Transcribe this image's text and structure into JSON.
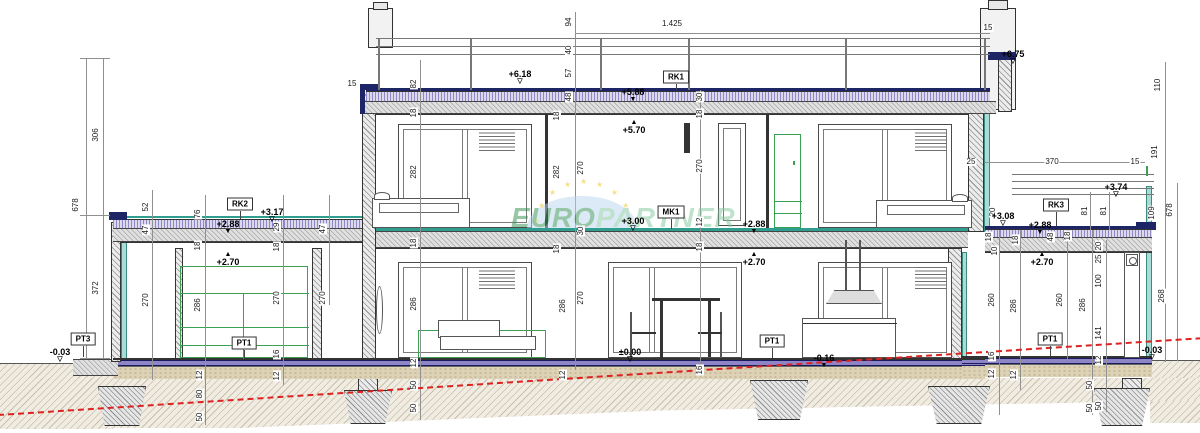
{
  "watermark": {
    "text_primary": "EURO",
    "text_secondary": "PARTNER"
  },
  "reference_boxes": [
    {
      "t": "RK1",
      "x": 676,
      "y": 77,
      "ly": 90
    },
    {
      "t": "RK2",
      "x": 240,
      "y": 204,
      "ly": 219
    },
    {
      "t": "RK3",
      "x": 1056,
      "y": 205,
      "ly": 226
    },
    {
      "t": "MK1",
      "x": 671,
      "y": 212,
      "ly": 229
    },
    {
      "t": "PT1",
      "x": 244,
      "y": 343,
      "ly": 358
    },
    {
      "t": "PT1",
      "x": 772,
      "y": 341,
      "ly": 358
    },
    {
      "t": "PT1",
      "x": 1050,
      "y": 339,
      "ly": 356
    },
    {
      "t": "PT3",
      "x": 83,
      "y": 339,
      "ly": 357
    }
  ],
  "level_marks": [
    {
      "t": "+6.18",
      "x": 520,
      "y": 70,
      "m": "od"
    },
    {
      "t": "+5.88",
      "x": 633,
      "y": 88,
      "m": "fd"
    },
    {
      "t": "+5.70",
      "x": 634,
      "y": 120,
      "m": "fu"
    },
    {
      "t": "+6.75",
      "x": 1013,
      "y": 50,
      "m": "od"
    },
    {
      "t": "+3.74",
      "x": 1116,
      "y": 183,
      "m": "od"
    },
    {
      "t": "+3.17",
      "x": 272,
      "y": 208,
      "m": "od"
    },
    {
      "t": "+2.88",
      "x": 228,
      "y": 220,
      "m": "fd"
    },
    {
      "t": "+2.70",
      "x": 228,
      "y": 252,
      "m": "fu"
    },
    {
      "t": "+3.00",
      "x": 633,
      "y": 217,
      "m": "od"
    },
    {
      "t": "+2.88",
      "x": 754,
      "y": 220,
      "m": "fd"
    },
    {
      "t": "+2.70",
      "x": 754,
      "y": 252,
      "m": "fu"
    },
    {
      "t": "+3.08",
      "x": 1003,
      "y": 212,
      "m": "od"
    },
    {
      "t": "+2.88",
      "x": 1040,
      "y": 221,
      "m": "fd"
    },
    {
      "t": "+2.70",
      "x": 1042,
      "y": 252,
      "m": "fu"
    },
    {
      "t": "±0.00",
      "x": 630,
      "y": 348,
      "m": "od"
    },
    {
      "t": "-0.16",
      "x": 824,
      "y": 354,
      "m": "fd"
    },
    {
      "t": "-0.03",
      "x": 60,
      "y": 348,
      "m": "od"
    },
    {
      "t": "-0.03",
      "x": 1152,
      "y": 346,
      "m": "od"
    }
  ],
  "dimensions": [
    {
      "t": "678",
      "x": 76,
      "y": 205,
      "r": 1
    },
    {
      "t": "306",
      "x": 96,
      "y": 135,
      "r": 1
    },
    {
      "t": "372",
      "x": 96,
      "y": 288,
      "r": 1
    },
    {
      "t": "52",
      "x": 146,
      "y": 207,
      "r": 1
    },
    {
      "t": "47",
      "x": 146,
      "y": 230,
      "r": 1
    },
    {
      "t": "270",
      "x": 146,
      "y": 300,
      "r": 1
    },
    {
      "t": "76",
      "x": 198,
      "y": 214,
      "r": 1
    },
    {
      "t": "18",
      "x": 198,
      "y": 246,
      "r": 1
    },
    {
      "t": "286",
      "x": 198,
      "y": 305,
      "r": 1
    },
    {
      "t": "12",
      "x": 200,
      "y": 375,
      "r": 1
    },
    {
      "t": "80",
      "x": 200,
      "y": 394,
      "r": 1
    },
    {
      "t": "50",
      "x": 200,
      "y": 417,
      "r": 1
    },
    {
      "t": "29",
      "x": 277,
      "y": 227,
      "r": 1
    },
    {
      "t": "18",
      "x": 277,
      "y": 247,
      "r": 1
    },
    {
      "t": "270",
      "x": 277,
      "y": 298,
      "r": 1
    },
    {
      "t": "16",
      "x": 277,
      "y": 354,
      "r": 1
    },
    {
      "t": "12",
      "x": 277,
      "y": 376,
      "r": 1
    },
    {
      "t": "47",
      "x": 323,
      "y": 229,
      "r": 1
    },
    {
      "t": "270",
      "x": 323,
      "y": 298,
      "r": 1
    },
    {
      "t": "15",
      "x": 352,
      "y": 84,
      "r": 0
    },
    {
      "t": "82",
      "x": 414,
      "y": 84,
      "r": 1
    },
    {
      "t": "18",
      "x": 414,
      "y": 113,
      "r": 1
    },
    {
      "t": "282",
      "x": 414,
      "y": 172,
      "r": 1
    },
    {
      "t": "18",
      "x": 414,
      "y": 243,
      "r": 1
    },
    {
      "t": "286",
      "x": 414,
      "y": 304,
      "r": 1
    },
    {
      "t": "12",
      "x": 414,
      "y": 363,
      "r": 1
    },
    {
      "t": "50",
      "x": 414,
      "y": 385,
      "r": 1
    },
    {
      "t": "50",
      "x": 414,
      "y": 408,
      "r": 1
    },
    {
      "t": "94",
      "x": 569,
      "y": 22,
      "r": 1
    },
    {
      "t": "1.425",
      "x": 672,
      "y": 24,
      "r": 0
    },
    {
      "t": "40",
      "x": 569,
      "y": 50,
      "r": 1
    },
    {
      "t": "57",
      "x": 569,
      "y": 73,
      "r": 1
    },
    {
      "t": "48",
      "x": 569,
      "y": 97,
      "r": 1
    },
    {
      "t": "18",
      "x": 557,
      "y": 116,
      "r": 1
    },
    {
      "t": "282",
      "x": 557,
      "y": 172,
      "r": 1
    },
    {
      "t": "270",
      "x": 581,
      "y": 168,
      "r": 1
    },
    {
      "t": "30",
      "x": 581,
      "y": 231,
      "r": 1
    },
    {
      "t": "18",
      "x": 557,
      "y": 249,
      "r": 1
    },
    {
      "t": "286",
      "x": 563,
      "y": 306,
      "r": 1
    },
    {
      "t": "270",
      "x": 581,
      "y": 298,
      "r": 1
    },
    {
      "t": "12",
      "x": 563,
      "y": 375,
      "r": 1
    },
    {
      "t": "30",
      "x": 700,
      "y": 97,
      "r": 1
    },
    {
      "t": "18",
      "x": 700,
      "y": 114,
      "r": 1
    },
    {
      "t": "270",
      "x": 700,
      "y": 166,
      "r": 1
    },
    {
      "t": "12",
      "x": 700,
      "y": 222,
      "r": 1
    },
    {
      "t": "18",
      "x": 700,
      "y": 247,
      "r": 1
    },
    {
      "t": "16",
      "x": 700,
      "y": 370,
      "r": 1
    },
    {
      "t": "15",
      "x": 988,
      "y": 28,
      "r": 0
    },
    {
      "t": "110",
      "x": 1158,
      "y": 85,
      "r": 1
    },
    {
      "t": "191",
      "x": 1155,
      "y": 152,
      "r": 1
    },
    {
      "t": "25",
      "x": 971,
      "y": 162,
      "r": 0
    },
    {
      "t": "370",
      "x": 1052,
      "y": 162,
      "r": 0
    },
    {
      "t": "15",
      "x": 1135,
      "y": 162,
      "r": 0
    },
    {
      "t": "20",
      "x": 993,
      "y": 212,
      "r": 1
    },
    {
      "t": "18",
      "x": 989,
      "y": 237,
      "r": 1
    },
    {
      "t": "10",
      "x": 995,
      "y": 251,
      "r": 1
    },
    {
      "t": "81",
      "x": 1085,
      "y": 211,
      "r": 1
    },
    {
      "t": "81",
      "x": 1104,
      "y": 211,
      "r": 1
    },
    {
      "t": "109",
      "x": 1152,
      "y": 213,
      "r": 1
    },
    {
      "t": "678",
      "x": 1170,
      "y": 210,
      "r": 1
    },
    {
      "t": "268",
      "x": 1162,
      "y": 296,
      "r": 1
    },
    {
      "t": "18",
      "x": 1016,
      "y": 240,
      "r": 1
    },
    {
      "t": "48",
      "x": 1051,
      "y": 237,
      "r": 1
    },
    {
      "t": "18",
      "x": 1068,
      "y": 236,
      "r": 1
    },
    {
      "t": "20",
      "x": 1099,
      "y": 246,
      "r": 1
    },
    {
      "t": "25",
      "x": 1099,
      "y": 259,
      "r": 1
    },
    {
      "t": "100",
      "x": 1099,
      "y": 281,
      "r": 1
    },
    {
      "t": "141",
      "x": 1099,
      "y": 333,
      "r": 1
    },
    {
      "t": "12",
      "x": 1099,
      "y": 360,
      "r": 1
    },
    {
      "t": "50",
      "x": 1099,
      "y": 406,
      "r": 1
    },
    {
      "t": "260",
      "x": 992,
      "y": 300,
      "r": 1
    },
    {
      "t": "286",
      "x": 1014,
      "y": 306,
      "r": 1
    },
    {
      "t": "260",
      "x": 1060,
      "y": 300,
      "r": 1
    },
    {
      "t": "286",
      "x": 1083,
      "y": 305,
      "r": 1
    },
    {
      "t": "16",
      "x": 992,
      "y": 356,
      "r": 1
    },
    {
      "t": "12",
      "x": 992,
      "y": 374,
      "r": 1
    },
    {
      "t": "12",
      "x": 1014,
      "y": 375,
      "r": 1
    },
    {
      "t": "50",
      "x": 1090,
      "y": 385,
      "r": 1
    },
    {
      "t": "50",
      "x": 1090,
      "y": 408,
      "r": 1
    }
  ]
}
